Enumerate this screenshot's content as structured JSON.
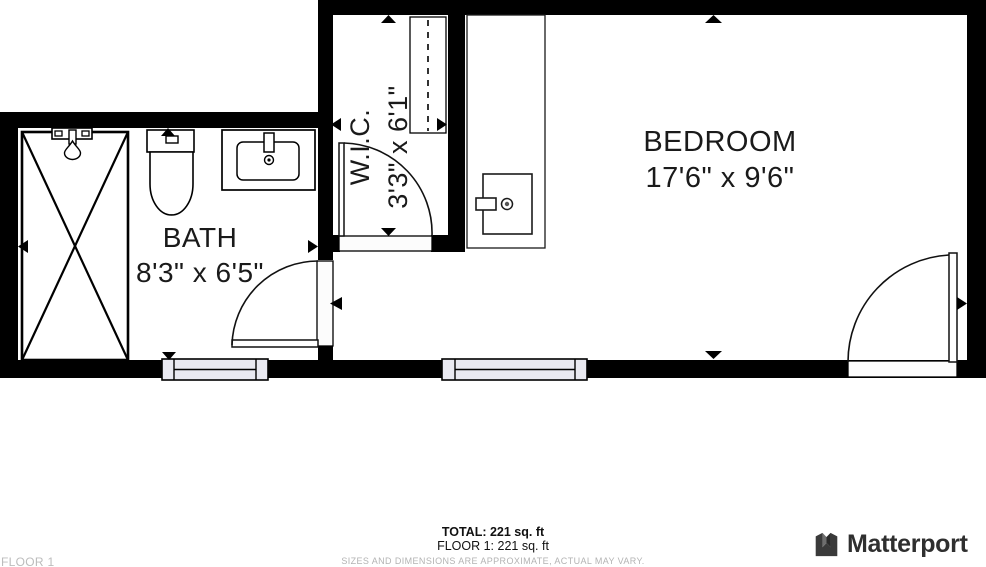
{
  "plan": {
    "rooms": [
      {
        "id": "bedroom",
        "name": "BEDROOM",
        "dims": "17'6\" x 9'6\""
      },
      {
        "id": "bath",
        "name": "BATH",
        "dims": "8'3\" x 6'5\""
      },
      {
        "id": "wic",
        "name": "W.I.C.",
        "dims": "3'3\" x 6'1\""
      }
    ],
    "fixtures": [
      "shower",
      "toilet",
      "sink-vanity",
      "closet-rod",
      "water-heater"
    ],
    "door_count": 3,
    "window_count": 2
  },
  "footer": {
    "total_label": "TOTAL: 221 sq. ft",
    "floor_total_label": "FLOOR 1: 221 sq. ft",
    "disclaimer": "SIZES AND DIMENSIONS ARE APPROXIMATE, ACTUAL MAY VARY.",
    "floor_name": "FLOOR 1"
  },
  "brand": {
    "name": "Matterport"
  },
  "colors": {
    "wall": "#000000",
    "window_fill": "#e9e9f1",
    "text": "#1a1a1a",
    "muted": "#b3b3b3",
    "brand_dark": "#333333"
  }
}
